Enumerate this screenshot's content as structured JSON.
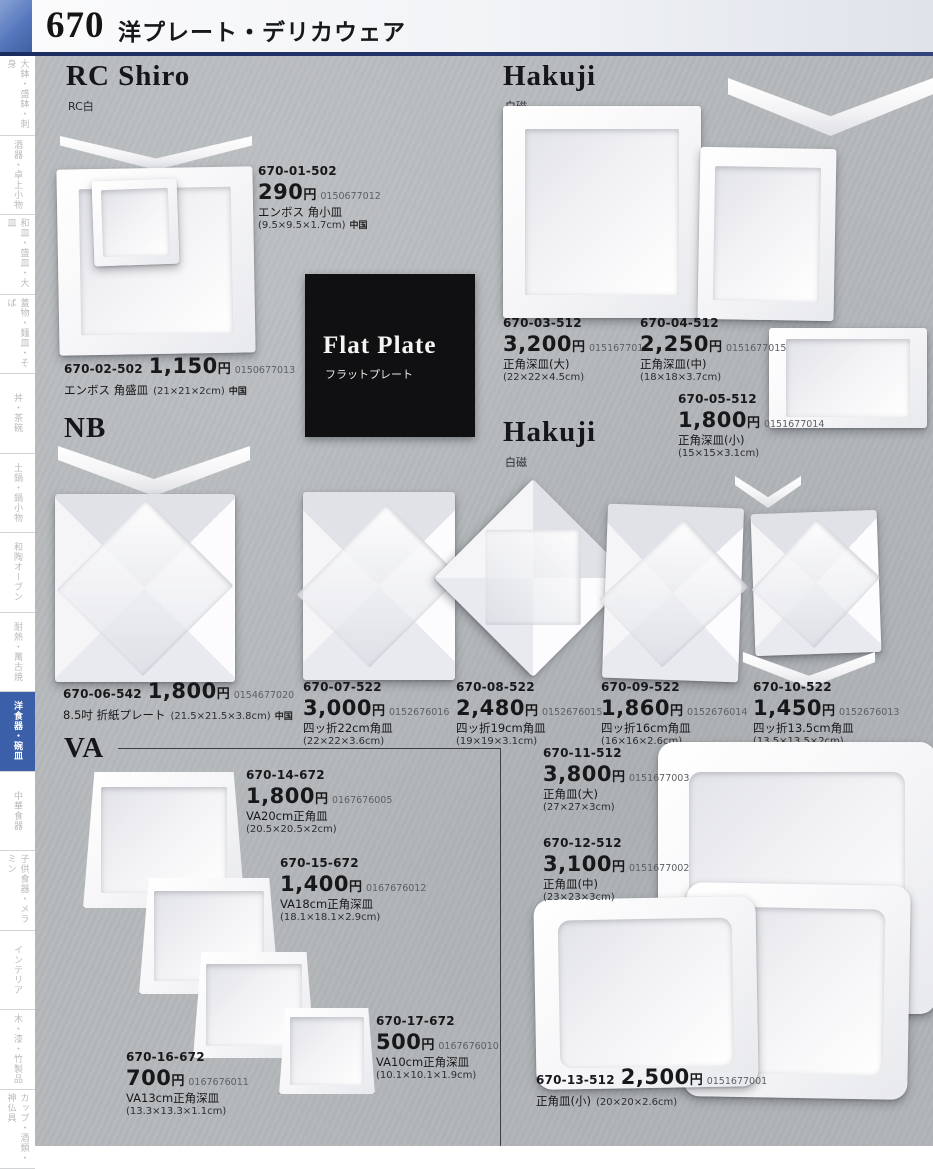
{
  "header": {
    "page_number": "670",
    "title": "洋プレート・デリカウェア"
  },
  "labels": {
    "currency": "円"
  },
  "sidebar": {
    "items": [
      {
        "label": "大鉢・盛鉢・刺身",
        "active": false
      },
      {
        "label": "酒器・卓上小物",
        "active": false
      },
      {
        "label": "和皿・盛皿・大皿",
        "active": false
      },
      {
        "label": "蓋物・麺皿・そば",
        "active": false
      },
      {
        "label": "丼・茶碗",
        "active": false
      },
      {
        "label": "土鍋・鍋小物",
        "active": false
      },
      {
        "label": "和陶オーブン",
        "active": false
      },
      {
        "label": "耐熱・萬古焼",
        "active": false
      },
      {
        "label": "洋食器・碗皿",
        "active": true
      },
      {
        "label": "中華食器",
        "active": false
      },
      {
        "label": "子供食器・メラミン",
        "active": false
      },
      {
        "label": "インテリア",
        "active": false
      },
      {
        "label": "木・漆・竹製品",
        "active": false
      },
      {
        "label": "カップ・酒類・神仏具",
        "active": false
      }
    ]
  },
  "sections": {
    "rc_shiro": {
      "title": "RC Shiro",
      "subtitle": "RC白"
    },
    "hakuji_top": {
      "title": "Hakuji",
      "subtitle": "白磁"
    },
    "flat_plate": {
      "title": "Flat Plate",
      "subtitle": "フラットプレート"
    },
    "nb": {
      "title": "NB"
    },
    "hakuji_mid": {
      "title": "Hakuji",
      "subtitle": "白磁"
    },
    "va": {
      "title": "VA"
    }
  },
  "products": {
    "p01": {
      "code": "670-01-502",
      "price": "290",
      "ref": "0150677012",
      "name": "エンボス 角小皿",
      "size": "(9.5×9.5×1.7cm)",
      "origin": "中国"
    },
    "p02": {
      "code": "670-02-502",
      "price": "1,150",
      "ref": "0150677013",
      "name": "エンボス 角盛皿",
      "size": "(21×21×2cm)",
      "origin": "中国"
    },
    "p03": {
      "code": "670-03-512",
      "price": "3,200",
      "ref": "0151677016",
      "name": "正角深皿(大)",
      "size": "(22×22×4.5cm)"
    },
    "p04": {
      "code": "670-04-512",
      "price": "2,250",
      "ref": "0151677015",
      "name": "正角深皿(中)",
      "size": "(18×18×3.7cm)"
    },
    "p05": {
      "code": "670-05-512",
      "price": "1,800",
      "ref": "0151677014",
      "name": "正角深皿(小)",
      "size": "(15×15×3.1cm)"
    },
    "p06": {
      "code": "670-06-542",
      "price": "1,800",
      "ref": "0154677020",
      "name": "8.5吋 折紙プレート",
      "size": "(21.5×21.5×3.8cm)",
      "origin": "中国"
    },
    "p07": {
      "code": "670-07-522",
      "price": "3,000",
      "ref": "0152676016",
      "name": "四ッ折22cm角皿",
      "size": "(22×22×3.6cm)"
    },
    "p08": {
      "code": "670-08-522",
      "price": "2,480",
      "ref": "0152676015",
      "name": "四ッ折19cm角皿",
      "size": "(19×19×3.1cm)"
    },
    "p09": {
      "code": "670-09-522",
      "price": "1,860",
      "ref": "0152676014",
      "name": "四ッ折16cm角皿",
      "size": "(16×16×2.6cm)"
    },
    "p10": {
      "code": "670-10-522",
      "price": "1,450",
      "ref": "0152676013",
      "name": "四ッ折13.5cm角皿",
      "size": "(13.5×13.5×2cm)"
    },
    "p11": {
      "code": "670-11-512",
      "price": "3,800",
      "ref": "0151677003",
      "name": "正角皿(大)",
      "size": "(27×27×3cm)"
    },
    "p12": {
      "code": "670-12-512",
      "price": "3,100",
      "ref": "0151677002",
      "name": "正角皿(中)",
      "size": "(23×23×3cm)"
    },
    "p13": {
      "code": "670-13-512",
      "price": "2,500",
      "ref": "0151677001",
      "name": "正角皿(小)",
      "size": "(20×20×2.6cm)"
    },
    "p14": {
      "code": "670-14-672",
      "price": "1,800",
      "ref": "0167676005",
      "name": "VA20cm正角皿",
      "size": "(20.5×20.5×2cm)"
    },
    "p15": {
      "code": "670-15-672",
      "price": "1,400",
      "ref": "0167676012",
      "name": "VA18cm正角深皿",
      "size": "(18.1×18.1×2.9cm)"
    },
    "p16": {
      "code": "670-16-672",
      "price": "700",
      "ref": "0167676011",
      "name": "VA13cm正角深皿",
      "size": "(13.3×13.3×1.1cm)"
    },
    "p17": {
      "code": "670-17-672",
      "price": "500",
      "ref": "0167676010",
      "name": "VA10cm正角深皿",
      "size": "(10.1×10.1×1.9cm)"
    }
  }
}
